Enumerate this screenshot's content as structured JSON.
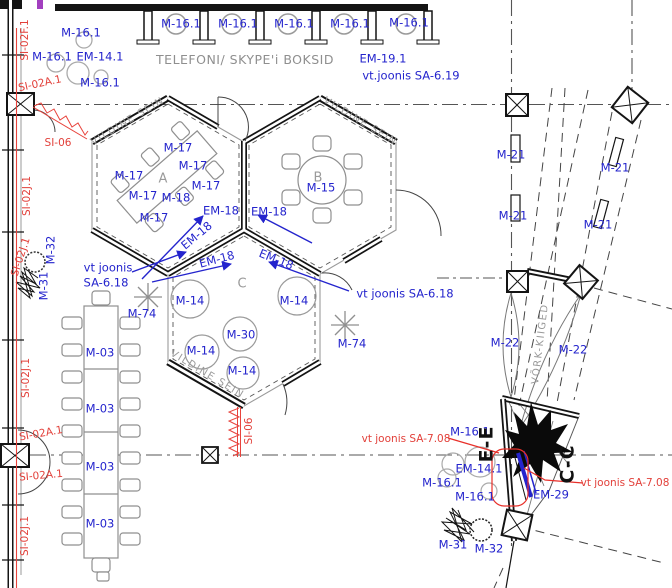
{
  "meta": {
    "drawing_type": "architectural floor plan",
    "width": 672,
    "height": 588
  },
  "colors": {
    "annotation_blue": "#2424cd",
    "annotation_red": "#e2403a",
    "leader_red": "#e8302a",
    "drawing_gray": "#8f8f8f",
    "wall_black": "#141414"
  },
  "texts": {
    "booths_area": "TELEFONI/ SKYPE'i BOKSID",
    "felt_wall": "VILDINE SEIN",
    "net_swings": "VÕRK-KIIGED"
  },
  "annotations": [
    {
      "t": "M-16.1",
      "x": 181,
      "y": 24
    },
    {
      "t": "M-16.1",
      "x": 238,
      "y": 24
    },
    {
      "t": "M-16.1",
      "x": 294,
      "y": 24
    },
    {
      "t": "M-16.1",
      "x": 350,
      "y": 24
    },
    {
      "t": "M-16.1",
      "x": 409,
      "y": 23
    },
    {
      "t": "M-16.1",
      "x": 81,
      "y": 33
    },
    {
      "t": "M-16.1",
      "x": 52,
      "y": 57
    },
    {
      "t": "EM-14.1",
      "x": 100,
      "y": 57
    },
    {
      "t": "M-16.1",
      "x": 100,
      "y": 83
    },
    {
      "t": "EM-19.1",
      "x": 383,
      "y": 59
    },
    {
      "t": "vt.joonis SA-6.19",
      "x": 411,
      "y": 76
    },
    {
      "t": "M-17",
      "x": 178,
      "y": 148
    },
    {
      "t": "M-17",
      "x": 193,
      "y": 166
    },
    {
      "t": "M-17",
      "x": 129,
      "y": 176
    },
    {
      "t": "M-17",
      "x": 206,
      "y": 186
    },
    {
      "t": "M-17",
      "x": 143,
      "y": 196
    },
    {
      "t": "M-18",
      "x": 176,
      "y": 198
    },
    {
      "t": "M-17",
      "x": 154,
      "y": 218
    },
    {
      "t": "M-15",
      "x": 321,
      "y": 188
    },
    {
      "t": "EM-18",
      "x": 221,
      "y": 211
    },
    {
      "t": "EM-18",
      "x": 269,
      "y": 212
    },
    {
      "t": "EM-18",
      "x": 197,
      "y": 236,
      "r": -40
    },
    {
      "t": "EM-18",
      "x": 217,
      "y": 260,
      "r": -15
    },
    {
      "t": "EM-18",
      "x": 276,
      "y": 260,
      "r": 22
    },
    {
      "t": "vt joonis",
      "x": 108,
      "y": 268
    },
    {
      "t": "SA-6.18",
      "x": 106,
      "y": 283
    },
    {
      "t": "vt joonis SA-6.18",
      "x": 405,
      "y": 294
    },
    {
      "t": "M-74",
      "x": 142,
      "y": 314
    },
    {
      "t": "M-74",
      "x": 352,
      "y": 344
    },
    {
      "t": "M-14",
      "x": 190,
      "y": 301
    },
    {
      "t": "M-14",
      "x": 294,
      "y": 301
    },
    {
      "t": "M-30",
      "x": 241,
      "y": 335
    },
    {
      "t": "M-14",
      "x": 201,
      "y": 351
    },
    {
      "t": "M-14",
      "x": 242,
      "y": 371
    },
    {
      "t": "M-03",
      "x": 100,
      "y": 353
    },
    {
      "t": "M-03",
      "x": 100,
      "y": 409
    },
    {
      "t": "M-03",
      "x": 100,
      "y": 467
    },
    {
      "t": "M-03",
      "x": 100,
      "y": 524
    },
    {
      "t": "M-21",
      "x": 511,
      "y": 155
    },
    {
      "t": "M-21",
      "x": 615,
      "y": 168
    },
    {
      "t": "M-21",
      "x": 513,
      "y": 216
    },
    {
      "t": "M-21",
      "x": 598,
      "y": 225
    },
    {
      "t": "M-22",
      "x": 505,
      "y": 343
    },
    {
      "t": "M-22",
      "x": 573,
      "y": 350
    },
    {
      "t": "M-32",
      "x": 51,
      "y": 250,
      "r": -90
    },
    {
      "t": "M-31",
      "x": 44,
      "y": 286,
      "r": -90
    },
    {
      "t": "M-16.1",
      "x": 470,
      "y": 432
    },
    {
      "t": "EM-14.1",
      "x": 479,
      "y": 469
    },
    {
      "t": "M-16.1",
      "x": 442,
      "y": 483
    },
    {
      "t": "M-16.1",
      "x": 475,
      "y": 497
    },
    {
      "t": "EM-29",
      "x": 551,
      "y": 495
    },
    {
      "t": "M-31",
      "x": 453,
      "y": 545
    },
    {
      "t": "M-32",
      "x": 489,
      "y": 549
    },
    {
      "t": "SI-02F.1",
      "x": 25,
      "y": 40,
      "r": -90,
      "c": "red"
    },
    {
      "t": "SI-02A.1",
      "x": 40,
      "y": 84,
      "r": -12,
      "c": "red"
    },
    {
      "t": "SI-06",
      "x": 58,
      "y": 143,
      "c": "red"
    },
    {
      "t": "SI-02J.1",
      "x": 27,
      "y": 196,
      "r": -90,
      "c": "red"
    },
    {
      "t": "SI-02J.1",
      "x": 21,
      "y": 257,
      "r": -72,
      "c": "red"
    },
    {
      "t": "SI-02J.1",
      "x": 26,
      "y": 378,
      "r": -90,
      "c": "red"
    },
    {
      "t": "SI-02A.1",
      "x": 41,
      "y": 434,
      "r": -10,
      "c": "red"
    },
    {
      "t": "SI-02A.1",
      "x": 41,
      "y": 476,
      "r": -5,
      "c": "red"
    },
    {
      "t": "SI-02J.1",
      "x": 25,
      "y": 536,
      "r": -90,
      "c": "red"
    },
    {
      "t": "SI-06",
      "x": 249,
      "y": 431,
      "r": -90,
      "c": "red"
    },
    {
      "t": "vt joonis SA-7.08",
      "x": 406,
      "y": 439,
      "c": "red"
    },
    {
      "t": "vt joonis SA-7.08",
      "x": 625,
      "y": 483,
      "c": "red"
    },
    {
      "t": "TELEFONI/ SKYPE'i BOKSID",
      "x": 245,
      "y": 60,
      "c": "grayL"
    },
    {
      "t": "VILDINE SEIN",
      "x": 128,
      "y": 122,
      "r": -31,
      "c": "grayS"
    },
    {
      "t": "VILDINE SEIN",
      "x": 360,
      "y": 122,
      "r": 31,
      "c": "grayS"
    },
    {
      "t": "VILDINE SEIN",
      "x": 207,
      "y": 375,
      "r": 31,
      "c": "grayS"
    },
    {
      "t": "VÕRK-KIIGED",
      "x": 541,
      "y": 344,
      "r": -83,
      "c": "grayS"
    },
    {
      "t": "A",
      "x": 163,
      "y": 179,
      "c": "room"
    },
    {
      "t": "B",
      "x": 318,
      "y": 178,
      "c": "room"
    },
    {
      "t": "C",
      "x": 242,
      "y": 284,
      "c": "room"
    },
    {
      "t": "E-E",
      "x": 487,
      "y": 444,
      "r": -90,
      "c": "section"
    },
    {
      "t": "C-C",
      "x": 568,
      "y": 464,
      "r": -90,
      "c": "section"
    }
  ]
}
